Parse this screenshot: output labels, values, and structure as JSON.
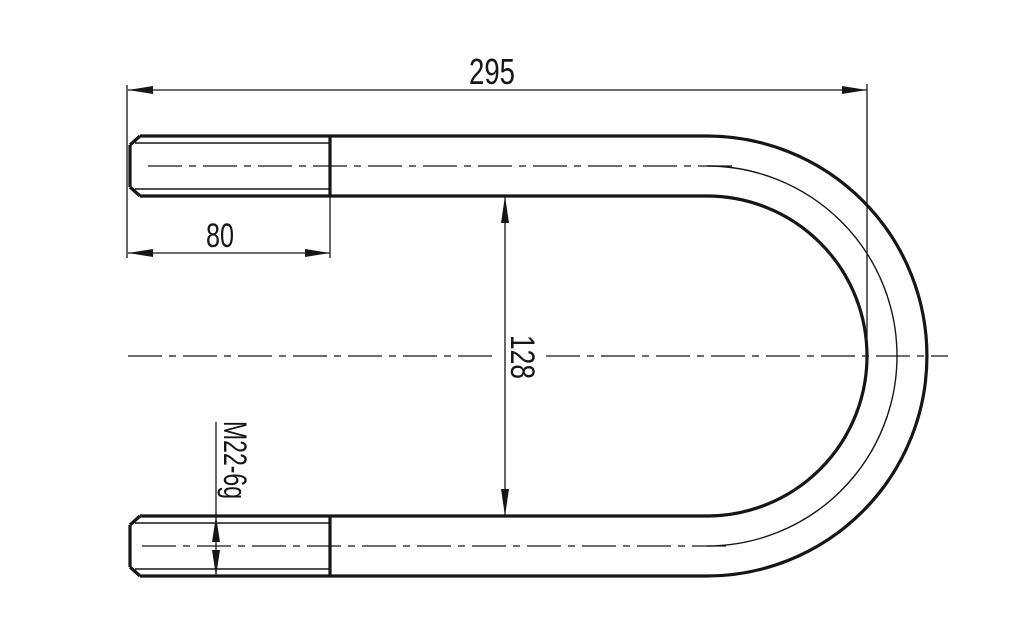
{
  "drawing": {
    "background_color": "#ffffff",
    "line_color": "#161616",
    "dimensions": {
      "overall_length": "295",
      "thread_length": "80",
      "leg_inner_span": "128",
      "thread_spec": "M22-6g"
    }
  }
}
